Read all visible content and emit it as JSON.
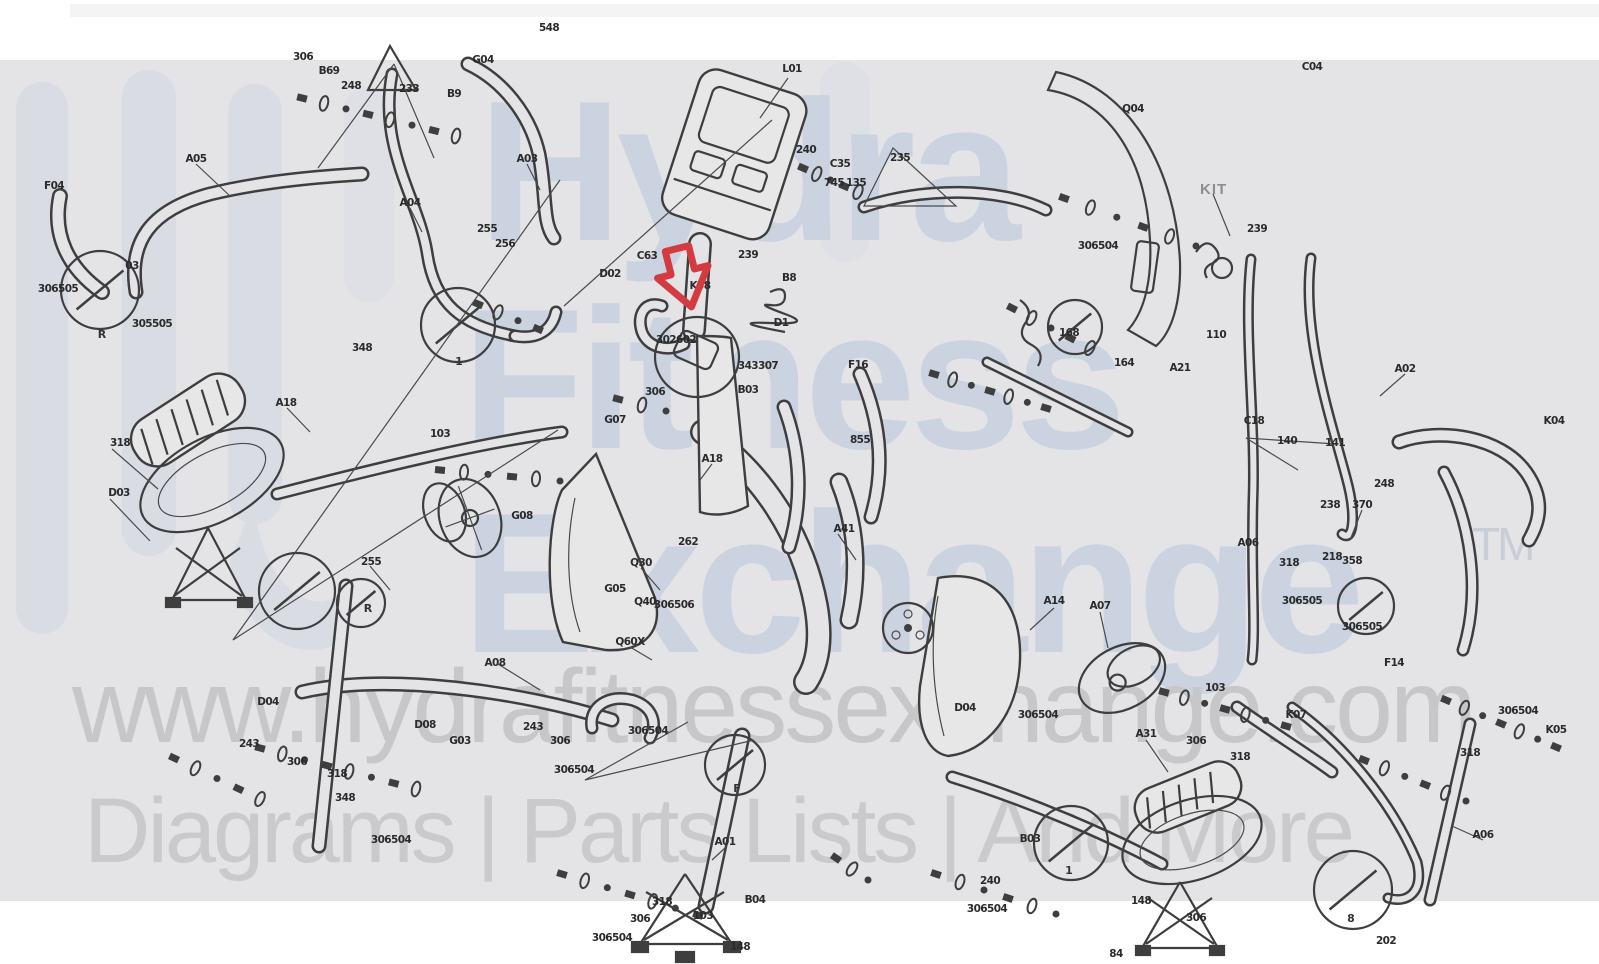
{
  "page": {
    "background": "#ffffff",
    "canvas_background": "#e4e4e6"
  },
  "watermark": {
    "brand_lines": [
      "Hydra",
      "Fitness",
      "Exchange"
    ],
    "trademark": "TM",
    "url": "www.hydrafitnessexchange.com",
    "tagline": "Diagrams | Parts Lists | And More",
    "brand_color": "#cbd3e1",
    "logo_color": "#d9dce3",
    "url_color": "#c7c7c9",
    "tagline_color": "#cacacc"
  },
  "diagram": {
    "type": "exploded-parts-diagram",
    "subject": "elliptical trainer parts schematic",
    "ink_color": "#3e3e3e",
    "highlight_arrow": {
      "color": "#d43b41",
      "x": 683,
      "y": 277,
      "points_to": "console mast elbow part"
    },
    "kit_label": {
      "text": "KIT",
      "x": 1213,
      "y": 190
    },
    "circle_letters": [
      {
        "t": "R",
        "x": 102,
        "y": 338
      },
      {
        "t": "R",
        "x": 368,
        "y": 612
      },
      {
        "t": "1",
        "x": 459,
        "y": 365
      },
      {
        "t": "F",
        "x": 737,
        "y": 792
      },
      {
        "t": "1",
        "x": 1069,
        "y": 874
      },
      {
        "t": "8",
        "x": 1351,
        "y": 922
      }
    ],
    "labels": [
      {
        "t": "548",
        "x": 549,
        "y": 31
      },
      {
        "t": "306",
        "x": 303,
        "y": 60
      },
      {
        "t": "B69",
        "x": 329,
        "y": 74
      },
      {
        "t": "248",
        "x": 351,
        "y": 89
      },
      {
        "t": "233",
        "x": 409,
        "y": 92
      },
      {
        "t": "B9",
        "x": 454,
        "y": 97
      },
      {
        "t": "G04",
        "x": 483,
        "y": 63
      },
      {
        "t": "A05",
        "x": 196,
        "y": 162
      },
      {
        "t": "F04",
        "x": 54,
        "y": 189
      },
      {
        "t": "A03",
        "x": 527,
        "y": 162
      },
      {
        "t": "A04",
        "x": 410,
        "y": 206
      },
      {
        "t": "L01",
        "x": 792,
        "y": 72
      },
      {
        "t": "306505",
        "x": 58,
        "y": 292
      },
      {
        "t": "03",
        "x": 132,
        "y": 269
      },
      {
        "t": "305505",
        "x": 152,
        "y": 327
      },
      {
        "t": "255",
        "x": 487,
        "y": 232
      },
      {
        "t": "256",
        "x": 505,
        "y": 247
      },
      {
        "t": "C63",
        "x": 647,
        "y": 259
      },
      {
        "t": "D02",
        "x": 610,
        "y": 277
      },
      {
        "t": "K58",
        "x": 700,
        "y": 289
      },
      {
        "t": "239",
        "x": 748,
        "y": 258
      },
      {
        "t": "B8",
        "x": 789,
        "y": 281
      },
      {
        "t": "302602",
        "x": 676,
        "y": 343
      },
      {
        "t": "D1",
        "x": 781,
        "y": 326
      },
      {
        "t": "343307",
        "x": 758,
        "y": 369
      },
      {
        "t": "B03",
        "x": 748,
        "y": 393
      },
      {
        "t": "306",
        "x": 655,
        "y": 395
      },
      {
        "t": "G07",
        "x": 615,
        "y": 423
      },
      {
        "t": "240",
        "x": 806,
        "y": 153
      },
      {
        "t": "C35",
        "x": 840,
        "y": 167
      },
      {
        "t": "135",
        "x": 856,
        "y": 186
      },
      {
        "t": "235",
        "x": 900,
        "y": 161
      },
      {
        "t": "745",
        "x": 834,
        "y": 186
      },
      {
        "t": "306504",
        "x": 1098,
        "y": 249
      },
      {
        "t": "168",
        "x": 1069,
        "y": 336
      },
      {
        "t": "164",
        "x": 1124,
        "y": 366
      },
      {
        "t": "A21",
        "x": 1180,
        "y": 371
      },
      {
        "t": "110",
        "x": 1216,
        "y": 338
      },
      {
        "t": "C18",
        "x": 1254,
        "y": 424
      },
      {
        "t": "140",
        "x": 1287,
        "y": 444
      },
      {
        "t": "141",
        "x": 1335,
        "y": 446
      },
      {
        "t": "248",
        "x": 1384,
        "y": 487
      },
      {
        "t": "238",
        "x": 1330,
        "y": 508
      },
      {
        "t": "218",
        "x": 1332,
        "y": 560
      },
      {
        "t": "Q04",
        "x": 1133,
        "y": 112
      },
      {
        "t": "239",
        "x": 1257,
        "y": 232
      },
      {
        "t": "C04",
        "x": 1312,
        "y": 70
      },
      {
        "t": "A02",
        "x": 1405,
        "y": 372
      },
      {
        "t": "A06",
        "x": 1248,
        "y": 546
      },
      {
        "t": "318",
        "x": 1289,
        "y": 566
      },
      {
        "t": "358",
        "x": 1352,
        "y": 564
      },
      {
        "t": "306505",
        "x": 1302,
        "y": 604
      },
      {
        "t": "K04",
        "x": 1554,
        "y": 424
      },
      {
        "t": "370",
        "x": 1362,
        "y": 508
      },
      {
        "t": "F16",
        "x": 858,
        "y": 368
      },
      {
        "t": "855",
        "x": 860,
        "y": 443
      },
      {
        "t": "A18",
        "x": 712,
        "y": 462
      },
      {
        "t": "A41",
        "x": 844,
        "y": 532
      },
      {
        "t": "A14",
        "x": 1054,
        "y": 604
      },
      {
        "t": "A07",
        "x": 1100,
        "y": 609
      },
      {
        "t": "Q30",
        "x": 641,
        "y": 566
      },
      {
        "t": "Q40",
        "x": 645,
        "y": 605
      },
      {
        "t": "Q60X",
        "x": 630,
        "y": 645
      },
      {
        "t": "262",
        "x": 688,
        "y": 545
      },
      {
        "t": "G05",
        "x": 615,
        "y": 592
      },
      {
        "t": "306506",
        "x": 674,
        "y": 608
      },
      {
        "t": "A31",
        "x": 1146,
        "y": 737
      },
      {
        "t": "306",
        "x": 1196,
        "y": 744
      },
      {
        "t": "318",
        "x": 1240,
        "y": 760
      },
      {
        "t": "103",
        "x": 1215,
        "y": 691
      },
      {
        "t": "K07",
        "x": 1296,
        "y": 718
      },
      {
        "t": "306504",
        "x": 1038,
        "y": 718
      },
      {
        "t": "D04",
        "x": 965,
        "y": 711
      },
      {
        "t": "240",
        "x": 990,
        "y": 884
      },
      {
        "t": "306504",
        "x": 987,
        "y": 912
      },
      {
        "t": "B03",
        "x": 1030,
        "y": 842
      },
      {
        "t": "148",
        "x": 1141,
        "y": 904
      },
      {
        "t": "84",
        "x": 1116,
        "y": 957
      },
      {
        "t": "306",
        "x": 1196,
        "y": 921
      },
      {
        "t": "202",
        "x": 1386,
        "y": 944
      },
      {
        "t": "A01",
        "x": 725,
        "y": 845
      },
      {
        "t": "306504",
        "x": 648,
        "y": 734
      },
      {
        "t": "306504",
        "x": 574,
        "y": 773
      },
      {
        "t": "318",
        "x": 662,
        "y": 905
      },
      {
        "t": "306",
        "x": 640,
        "y": 922
      },
      {
        "t": "103",
        "x": 703,
        "y": 919
      },
      {
        "t": "306504",
        "x": 612,
        "y": 941
      },
      {
        "t": "B04",
        "x": 755,
        "y": 903
      },
      {
        "t": "148",
        "x": 740,
        "y": 950
      },
      {
        "t": "A08",
        "x": 495,
        "y": 666
      },
      {
        "t": "243",
        "x": 533,
        "y": 730
      },
      {
        "t": "306",
        "x": 560,
        "y": 744
      },
      {
        "t": "D08",
        "x": 425,
        "y": 728
      },
      {
        "t": "G03",
        "x": 460,
        "y": 744
      },
      {
        "t": "A06",
        "x": 1483,
        "y": 838
      },
      {
        "t": "306504",
        "x": 1518,
        "y": 714
      },
      {
        "t": "K05",
        "x": 1556,
        "y": 733
      },
      {
        "t": "318",
        "x": 1470,
        "y": 756
      },
      {
        "t": "F14",
        "x": 1394,
        "y": 666
      },
      {
        "t": "306505",
        "x": 1362,
        "y": 630
      },
      {
        "t": "G08",
        "x": 522,
        "y": 519
      },
      {
        "t": "103",
        "x": 440,
        "y": 437
      },
      {
        "t": "D03",
        "x": 119,
        "y": 496
      },
      {
        "t": "318",
        "x": 120,
        "y": 446
      },
      {
        "t": "A18",
        "x": 286,
        "y": 406
      },
      {
        "t": "348",
        "x": 362,
        "y": 351
      },
      {
        "t": "255",
        "x": 371,
        "y": 565
      },
      {
        "t": "306504",
        "x": 391,
        "y": 843
      },
      {
        "t": "348",
        "x": 345,
        "y": 801
      },
      {
        "t": "D04",
        "x": 268,
        "y": 705
      },
      {
        "t": "243",
        "x": 249,
        "y": 747
      },
      {
        "t": "306",
        "x": 297,
        "y": 765
      },
      {
        "t": "318",
        "x": 337,
        "y": 777
      }
    ]
  }
}
